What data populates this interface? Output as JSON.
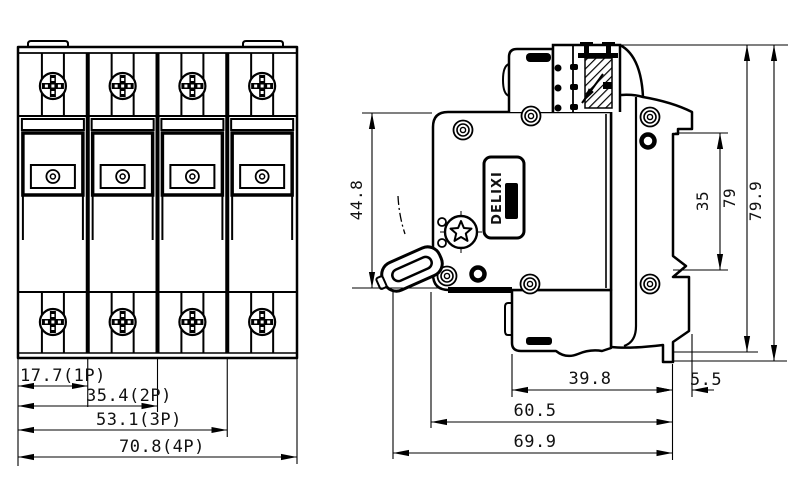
{
  "drawing_type": "circuit-breaker outline drawing, front and side views",
  "front_view": {
    "dims": [
      {
        "label": "17.7(1P)"
      },
      {
        "label": "35.4(2P)"
      },
      {
        "label": "53.1(3P)"
      },
      {
        "label": "70.8(4P)"
      }
    ]
  },
  "side_view": {
    "brand_label": "DELIXI",
    "dims": {
      "body_height": "44.8",
      "rail_opening": "35",
      "mount_height": "79",
      "total_height": "79.9",
      "lower_depth": "39.8",
      "foot_step": "5.5",
      "body_depth": "60.5",
      "total_depth": "69.9"
    }
  },
  "colors": {
    "line": "#000000",
    "background": "#ffffff"
  }
}
